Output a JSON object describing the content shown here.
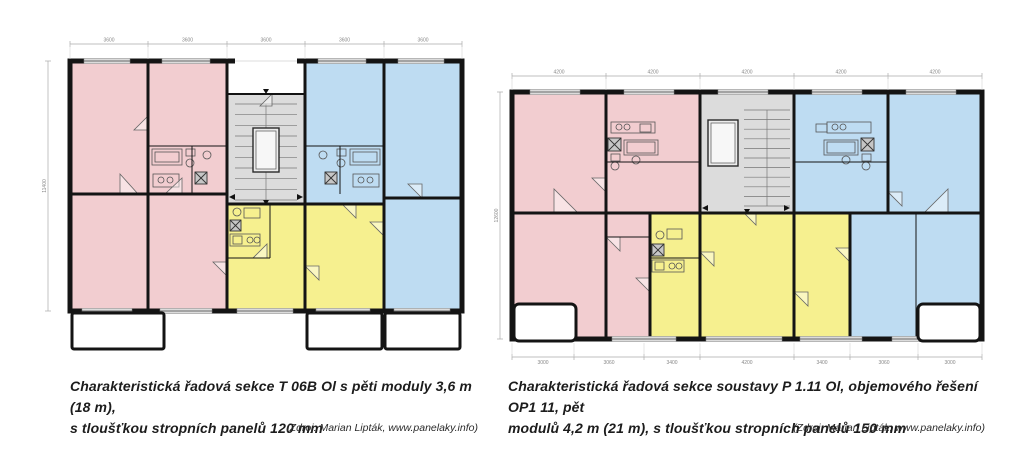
{
  "palette": {
    "pink": "#f2cdd0",
    "blue": "#bedcf2",
    "yellow": "#f6f08f",
    "gray": "#dcdcdc",
    "white": "#ffffff",
    "wall": "#141414"
  },
  "captions": {
    "left": {
      "line1": "Charakteristická řadová sekce T 06B Ol s pěti moduly 3,6 m (18 m),",
      "line2": "s tloušťkou stropních panelů 120 mm",
      "source": "(Zdroj: Marian Lipták, www.panelaky.info)"
    },
    "right": {
      "line1": "Charakteristická řadová sekce soustavy P 1.11 Ol, objemového řešení OP1 11, pět",
      "line2": "modulů 4,2 m (21 m), s tloušťkou stropních panelů 150 mm",
      "source": "(Zdroj: Marian Lipták, www.panelaky.info)"
    }
  },
  "plans": {
    "left": {
      "title": "T 06B Ol",
      "module_width_mm": "3600",
      "outer": {
        "x": 38,
        "y": 35,
        "w": 392,
        "h": 250
      },
      "rooms": [
        [
          38,
          35,
          78,
          133,
          "pink"
        ],
        [
          38,
          168,
          78,
          117,
          "pink"
        ],
        [
          116,
          35,
          79,
          85,
          "pink"
        ],
        [
          116,
          120,
          79,
          48,
          "pink"
        ],
        [
          116,
          168,
          79,
          117,
          "pink"
        ],
        [
          195,
          35,
          78,
          33,
          "white"
        ],
        [
          195,
          68,
          78,
          110,
          "gray"
        ],
        [
          195,
          178,
          78,
          107,
          "yellow"
        ],
        [
          273,
          35,
          79,
          85,
          "blue"
        ],
        [
          273,
          120,
          79,
          58,
          "blue"
        ],
        [
          273,
          178,
          79,
          107,
          "yellow"
        ],
        [
          352,
          35,
          78,
          137,
          "blue"
        ],
        [
          352,
          172,
          78,
          113,
          "blue"
        ]
      ],
      "stairs": {
        "x": 203,
        "y": 78,
        "w": 62,
        "h": 96,
        "n": 9
      },
      "elevator": {
        "x": 221,
        "y": 102,
        "w": 26,
        "h": 44
      },
      "fixtures": [
        {
          "t": "r",
          "x": 120,
          "y": 123,
          "w": 30,
          "h": 16
        },
        {
          "t": "r",
          "x": 123,
          "y": 126,
          "w": 24,
          "h": 10
        },
        {
          "t": "r",
          "x": 154,
          "y": 123,
          "w": 9,
          "h": 7
        },
        {
          "t": "c",
          "x": 158,
          "y": 137,
          "r": 4
        },
        {
          "t": "c",
          "x": 175,
          "y": 129,
          "r": 4
        },
        {
          "t": "x",
          "x": 163,
          "y": 146,
          "s": 12
        },
        {
          "t": "r",
          "x": 121,
          "y": 148,
          "w": 26,
          "h": 13
        },
        {
          "t": "c",
          "x": 129,
          "y": 154,
          "r": 3
        },
        {
          "t": "c",
          "x": 138,
          "y": 154,
          "r": 3
        },
        {
          "t": "r",
          "x": 318,
          "y": 123,
          "w": 30,
          "h": 16
        },
        {
          "t": "r",
          "x": 321,
          "y": 126,
          "w": 24,
          "h": 10
        },
        {
          "t": "r",
          "x": 305,
          "y": 123,
          "w": 9,
          "h": 7
        },
        {
          "t": "c",
          "x": 309,
          "y": 137,
          "r": 4
        },
        {
          "t": "c",
          "x": 291,
          "y": 129,
          "r": 4
        },
        {
          "t": "x",
          "x": 293,
          "y": 146,
          "s": 12
        },
        {
          "t": "r",
          "x": 321,
          "y": 148,
          "w": 26,
          "h": 13
        },
        {
          "t": "c",
          "x": 329,
          "y": 154,
          "r": 3
        },
        {
          "t": "c",
          "x": 338,
          "y": 154,
          "r": 3
        },
        {
          "t": "c",
          "x": 205,
          "y": 186,
          "r": 4
        },
        {
          "t": "r",
          "x": 212,
          "y": 182,
          "w": 16,
          "h": 10
        },
        {
          "t": "x",
          "x": 198,
          "y": 194,
          "s": 11
        },
        {
          "t": "r",
          "x": 198,
          "y": 208,
          "w": 30,
          "h": 12
        },
        {
          "t": "r",
          "x": 201,
          "y": 210,
          "w": 9,
          "h": 8
        },
        {
          "t": "c",
          "x": 218,
          "y": 214,
          "r": 3
        },
        {
          "t": "c",
          "x": 225,
          "y": 214,
          "r": 3
        }
      ],
      "doors": [
        "150,168 133,168 150,152",
        "88,168 106,168 88,148",
        "235,232 221,232 235,218",
        "273,240 287,254 287,240",
        "352,210 338,196 352,196",
        "240,68 228,80 240,80",
        "116,90 102,104 116,104",
        "390,172 376,158 390,158",
        "195,250 181,236 195,236",
        "310,178 324,192 324,178"
      ],
      "walls": [
        [
          116,
          35,
          116,
          285,
          3
        ],
        [
          195,
          35,
          195,
          285,
          3
        ],
        [
          273,
          35,
          273,
          285,
          3
        ],
        [
          352,
          35,
          352,
          285,
          3
        ],
        [
          38,
          168,
          195,
          168,
          3
        ],
        [
          195,
          178,
          352,
          178,
          3
        ],
        [
          352,
          172,
          430,
          172,
          3
        ],
        [
          195,
          68,
          273,
          68,
          2
        ],
        [
          116,
          120,
          195,
          120,
          1
        ],
        [
          273,
          120,
          352,
          120,
          1
        ],
        [
          160,
          120,
          160,
          168,
          1
        ],
        [
          308,
          120,
          308,
          168,
          1
        ],
        [
          238,
          178,
          238,
          232,
          1
        ],
        [
          195,
          232,
          238,
          232,
          1
        ]
      ],
      "gaps": [
        [
          203,
          31.8,
          62,
          6.4
        ]
      ],
      "windows": [
        [
          52,
          35,
          46
        ],
        [
          130,
          35,
          48
        ],
        [
          286,
          35,
          48
        ],
        [
          366,
          35,
          46
        ],
        [
          50,
          285,
          50
        ],
        [
          128,
          285,
          52
        ],
        [
          205,
          285,
          56
        ],
        [
          284,
          285,
          54
        ],
        [
          362,
          285,
          56
        ]
      ],
      "balconies": [
        [
          40,
          287,
          92,
          36,
          2
        ],
        [
          275,
          287,
          75,
          36,
          2
        ],
        [
          353,
          287,
          75,
          36,
          2
        ]
      ],
      "arrows": [
        "197,171 203,168 203,174",
        "271,171 265,168 265,174",
        "231,174 237,174 234,179",
        "231,63 237,63 234,68"
      ],
      "dims": [
        {
          "o": "h",
          "y": 18,
          "ext": 33,
          "ticks": [
            38,
            116,
            195,
            273,
            352,
            430
          ],
          "labels": [
            "3600",
            "3600",
            "3600",
            "3600",
            "3600"
          ]
        },
        {
          "o": "v",
          "x": 16,
          "y0": 35,
          "y1": 285,
          "label": "11400"
        }
      ]
    },
    "right": {
      "title": "P 1.11 Ol / OP1 11",
      "module_width_mm": "4200",
      "outer": {
        "x": 18,
        "y": 30,
        "w": 470,
        "h": 247
      },
      "rooms": [
        [
          18,
          30,
          94,
          121,
          "pink"
        ],
        [
          18,
          151,
          94,
          126,
          "pink"
        ],
        [
          112,
          30,
          94,
          121,
          "pink"
        ],
        [
          112,
          151,
          44,
          126,
          "pink"
        ],
        [
          156,
          151,
          50,
          126,
          "yellow"
        ],
        [
          206,
          30,
          94,
          121,
          "gray"
        ],
        [
          206,
          151,
          94,
          126,
          "yellow"
        ],
        [
          300,
          151,
          56,
          126,
          "yellow"
        ],
        [
          300,
          30,
          94,
          121,
          "blue"
        ],
        [
          394,
          30,
          94,
          121,
          "blue"
        ],
        [
          356,
          151,
          132,
          126,
          "blue"
        ]
      ],
      "stairs": {
        "x": 250,
        "y": 48,
        "w": 46,
        "h": 96,
        "n": 10
      },
      "elevator": {
        "x": 214,
        "y": 58,
        "w": 30,
        "h": 46
      },
      "fixtures": [
        {
          "t": "r",
          "x": 117,
          "y": 60,
          "w": 44,
          "h": 11
        },
        {
          "t": "c",
          "x": 125,
          "y": 65,
          "r": 3
        },
        {
          "t": "c",
          "x": 133,
          "y": 65,
          "r": 3
        },
        {
          "t": "r",
          "x": 146,
          "y": 62,
          "w": 11,
          "h": 8
        },
        {
          "t": "x",
          "x": 114,
          "y": 76,
          "s": 13
        },
        {
          "t": "r",
          "x": 130,
          "y": 78,
          "w": 34,
          "h": 15
        },
        {
          "t": "r",
          "x": 133,
          "y": 80,
          "w": 28,
          "h": 11
        },
        {
          "t": "r",
          "x": 117,
          "y": 92,
          "w": 9,
          "h": 7
        },
        {
          "t": "c",
          "x": 121,
          "y": 104,
          "r": 4
        },
        {
          "t": "c",
          "x": 142,
          "y": 98,
          "r": 4
        },
        {
          "t": "r",
          "x": 333,
          "y": 60,
          "w": 44,
          "h": 11
        },
        {
          "t": "c",
          "x": 341,
          "y": 65,
          "r": 3
        },
        {
          "t": "c",
          "x": 349,
          "y": 65,
          "r": 3
        },
        {
          "t": "r",
          "x": 322,
          "y": 62,
          "w": 11,
          "h": 8
        },
        {
          "t": "x",
          "x": 367,
          "y": 76,
          "s": 13
        },
        {
          "t": "r",
          "x": 330,
          "y": 78,
          "w": 34,
          "h": 15
        },
        {
          "t": "r",
          "x": 333,
          "y": 80,
          "w": 28,
          "h": 11
        },
        {
          "t": "r",
          "x": 368,
          "y": 92,
          "w": 9,
          "h": 7
        },
        {
          "t": "c",
          "x": 372,
          "y": 104,
          "r": 4
        },
        {
          "t": "c",
          "x": 352,
          "y": 98,
          "r": 4
        },
        {
          "t": "c",
          "x": 166,
          "y": 173,
          "r": 4
        },
        {
          "t": "r",
          "x": 173,
          "y": 167,
          "w": 15,
          "h": 10
        },
        {
          "t": "x",
          "x": 158,
          "y": 182,
          "s": 12
        },
        {
          "t": "r",
          "x": 158,
          "y": 198,
          "w": 32,
          "h": 12
        },
        {
          "t": "r",
          "x": 161,
          "y": 200,
          "w": 9,
          "h": 8
        },
        {
          "t": "c",
          "x": 178,
          "y": 204,
          "r": 3
        },
        {
          "t": "c",
          "x": 185,
          "y": 204,
          "r": 3
        }
      ],
      "doors": [
        "156,230 142,216 156,216",
        "206,190 220,204 220,190",
        "300,230 314,244 314,230",
        "356,200 342,186 356,186",
        "112,130 98,116 112,116",
        "394,130 408,144 408,130",
        "250,151 262,163 262,151",
        "112,175 126,189 126,175",
        "60,151 84,151 60,127",
        "430,151 454,151 454,127"
      ],
      "walls": [
        [
          112,
          30,
          112,
          277,
          3
        ],
        [
          206,
          30,
          206,
          277,
          3
        ],
        [
          300,
          30,
          300,
          277,
          3
        ],
        [
          394,
          30,
          394,
          151,
          3
        ],
        [
          156,
          151,
          156,
          277,
          3
        ],
        [
          356,
          151,
          356,
          277,
          3
        ],
        [
          18,
          151,
          488,
          151,
          3
        ],
        [
          422,
          151,
          422,
          277,
          1
        ],
        [
          112,
          100,
          206,
          100,
          1
        ],
        [
          300,
          100,
          394,
          100,
          1
        ],
        [
          156,
          196,
          206,
          196,
          1
        ],
        [
          112,
          175,
          156,
          175,
          1
        ]
      ],
      "gaps": [],
      "windows": [
        [
          36,
          30,
          50
        ],
        [
          130,
          30,
          50
        ],
        [
          224,
          30,
          50
        ],
        [
          318,
          30,
          50
        ],
        [
          412,
          30,
          50
        ],
        [
          30,
          277,
          46
        ],
        [
          118,
          277,
          64
        ],
        [
          212,
          277,
          76
        ],
        [
          306,
          277,
          62
        ],
        [
          398,
          277,
          48
        ]
      ],
      "balconies": [
        [
          20,
          242,
          62,
          37,
          5
        ],
        [
          424,
          242,
          62,
          37,
          5
        ]
      ],
      "arrows": [
        "208,146 214,143 214,149",
        "296,146 290,143 290,149",
        "250,147 256,147 253,152"
      ],
      "dims": [
        {
          "o": "h",
          "y": 14,
          "ext": 28,
          "ticks": [
            18,
            112,
            206,
            300,
            394,
            488
          ],
          "labels": [
            "4200",
            "4200",
            "4200",
            "4200",
            "4200"
          ]
        },
        {
          "o": "v",
          "x": 6,
          "y0": 30,
          "y1": 277,
          "label": "12600"
        },
        {
          "o": "h",
          "y": 295,
          "ext": 281,
          "lo": 7,
          "ticks": [
            18,
            80,
            150,
            206,
            300,
            356,
            424,
            488
          ],
          "labels": [
            "3000",
            "3060",
            "3400",
            "4200",
            "3400",
            "3060",
            "3000"
          ]
        }
      ]
    }
  }
}
